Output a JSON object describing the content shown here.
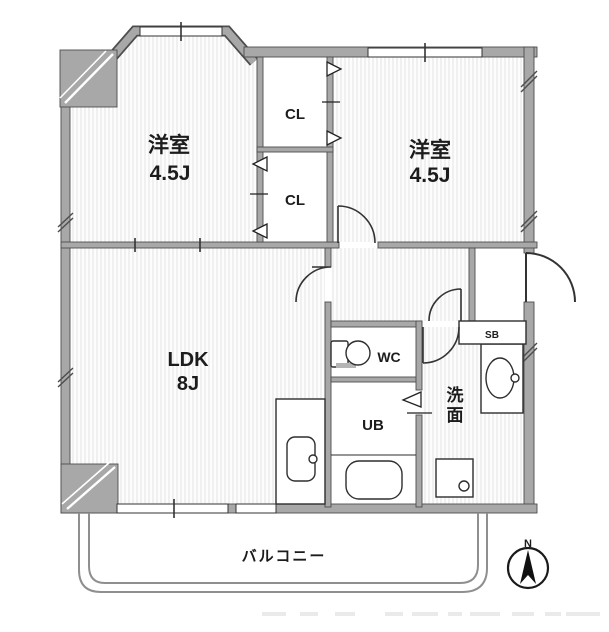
{
  "rooms": {
    "bedroom_left": {
      "name": "洋室",
      "size": "4.5J"
    },
    "bedroom_right": {
      "name": "洋室",
      "size": "4.5J"
    },
    "ldk": {
      "name": "LDK",
      "size": "8J"
    },
    "closet_top": {
      "label": "CL"
    },
    "closet_bottom": {
      "label": "CL"
    },
    "wc": {
      "label": "WC"
    },
    "unit_bath": {
      "label": "UB"
    },
    "washroom": {
      "label": "洗面"
    },
    "shoe_box": {
      "label": "SB"
    },
    "balcony": {
      "label": "バルコニー"
    }
  },
  "compass": {
    "north_label": "N"
  },
  "colors": {
    "wall_fill": "#a8a8a8",
    "wall_edge": "#4d4d4d",
    "floor_stripe": "#e8e8e8",
    "fixture_line": "#2e2e2e",
    "text": "#1c1c1c",
    "balcony_line": "#8f8f8f"
  }
}
